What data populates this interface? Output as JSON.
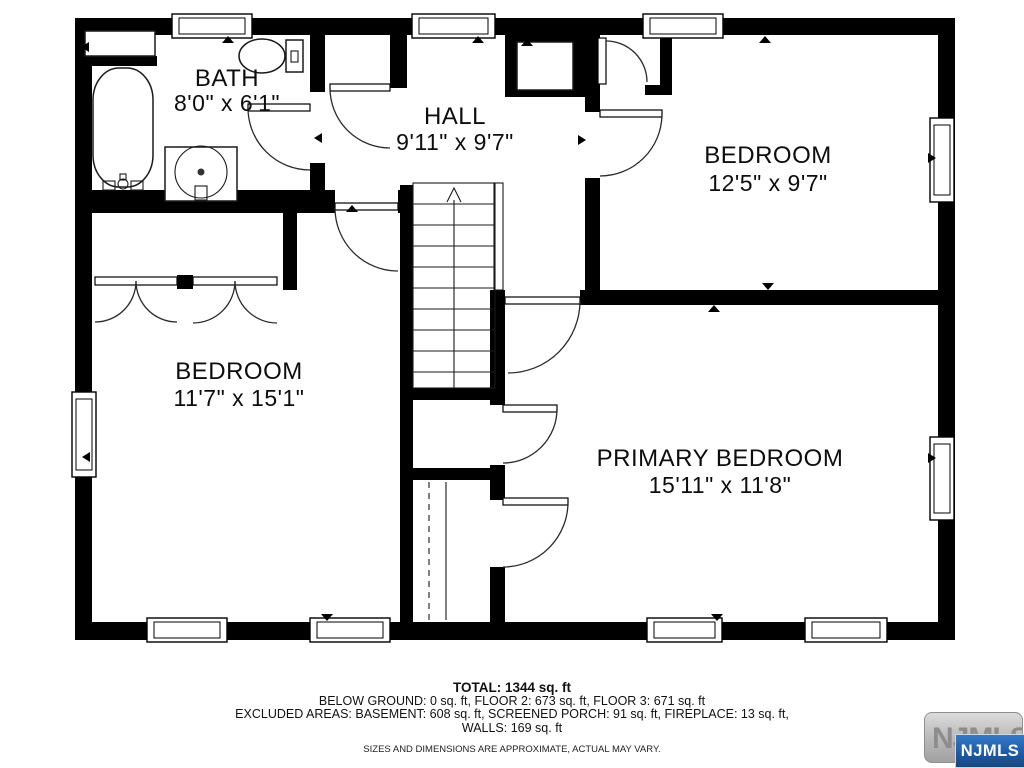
{
  "plan": {
    "rooms": [
      {
        "name": "BATH",
        "dims": "8'0\" x 6'1\""
      },
      {
        "name": "HALL",
        "dims": "9'11\" x 9'7\""
      },
      {
        "name": "BEDROOM",
        "dims": "12'5\" x 9'7\""
      },
      {
        "name": "BEDROOM",
        "dims": "11'7\" x 15'1\""
      },
      {
        "name": "PRIMARY BEDROOM",
        "dims": "15'11\" x 11'8\""
      }
    ],
    "stair_direction": "up"
  },
  "summary": {
    "total": "TOTAL: 1344 sq. ft",
    "line2": "BELOW GROUND: 0 sq. ft, FLOOR 2: 673 sq. ft, FLOOR 3: 671 sq. ft",
    "line3": "EXCLUDED AREAS: BASEMENT: 608 sq. ft, SCREENED PORCH: 91 sq. ft, FIREPLACE: 13 sq. ft,",
    "line4": "WALLS: 169 sq. ft",
    "disclaimer": "SIZES AND DIMENSIONS ARE APPROXIMATE, ACTUAL MAY VARY."
  },
  "logo": {
    "watermark_text": "NJMLS",
    "badge_text": "NJMLS",
    "badge_color": "#1d5ca8",
    "watermark_color": "#8d8d8d",
    "wall_color": "#000000"
  }
}
